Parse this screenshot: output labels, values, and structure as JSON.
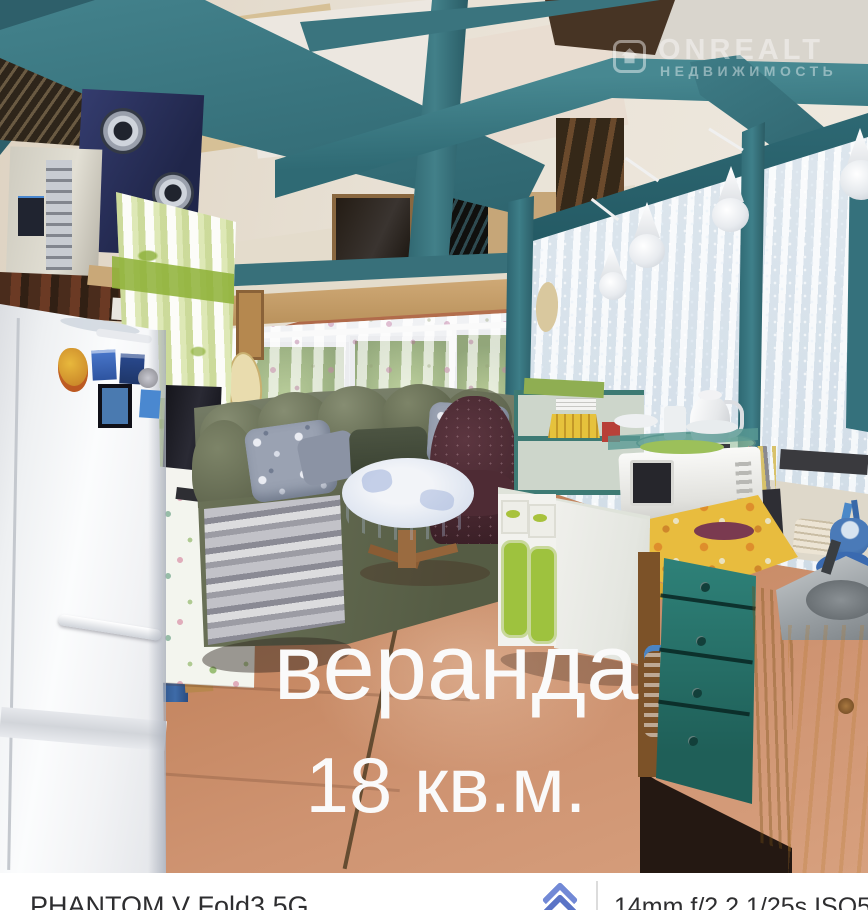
{
  "overlay": {
    "title": "веранда",
    "subtitle": "18 кв.м."
  },
  "watermark": {
    "brand": "ONREALT",
    "tagline": "НЕДВИЖИМОСТЬ",
    "icon": "house-icon"
  },
  "bottom_bar": {
    "device": "PHANTOM V Fold3 5G",
    "camera_info": "14mm f/2.2 1/25s ISO508",
    "icon": "brand-chevron-icon"
  },
  "colors": {
    "beam_teal": "#3d7a84",
    "floor_terracotta": "#b06b4a",
    "logo_blue": "#7289d6",
    "caption_white": "#fafafa",
    "bar_background": "#ffffff",
    "watermark_white": "rgba(255,255,255,0.42)"
  }
}
